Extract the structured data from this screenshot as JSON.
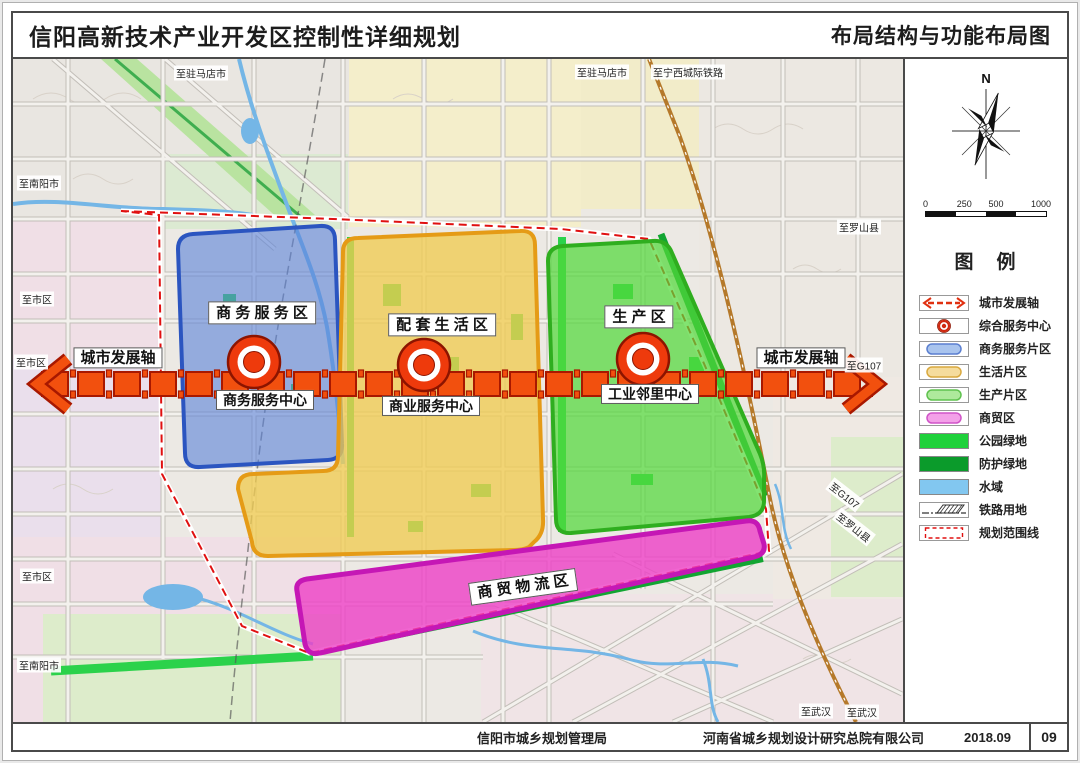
{
  "header": {
    "title_left": "信阳高新技术产业开发区控制性详细规划",
    "title_right": "布局结构与功能布局图"
  },
  "map": {
    "axis_label": "城市发展轴",
    "axis_color": "#f2500e",
    "axis_outline": "#a81800",
    "center_color": "#ee3a0c",
    "zones": [
      {
        "label": "商 务 服 务 区",
        "center_label": "商务服务中心",
        "fill": "#5a82d8",
        "stroke": "#2b55c0"
      },
      {
        "label": "配 套 生 活 区",
        "center_label": "商业服务中心",
        "fill": "#f0cc52",
        "stroke": "#e59b16"
      },
      {
        "label": "生 产 区",
        "center_label": "工业邻里中心",
        "fill": "#52d83a",
        "stroke": "#2fae1f"
      },
      {
        "label": "商 贸 物 流 区",
        "fill": "#ee3fc6",
        "stroke": "#c517b5"
      }
    ],
    "edge_labels": [
      {
        "text": "至驻马店市"
      },
      {
        "text": "至驻马店市"
      },
      {
        "text": "至宁西城际铁路"
      },
      {
        "text": "至南阳市"
      },
      {
        "text": "至市区"
      },
      {
        "text": "至市区"
      },
      {
        "text": "至市区"
      },
      {
        "text": "至南阳市"
      },
      {
        "text": "至罗山县"
      },
      {
        "text": "至G107"
      },
      {
        "text": "至G107"
      },
      {
        "text": "至罗山县"
      },
      {
        "text": "至武汉"
      },
      {
        "text": "至武汉"
      }
    ]
  },
  "panel": {
    "north_label": "N",
    "scale_labels": [
      "0",
      "250",
      "500",
      "1000"
    ],
    "legend_title": "图　例",
    "legend_items": [
      {
        "label": "城市发展轴",
        "color": "#e03010"
      },
      {
        "label": "综合服务中心",
        "color": "#d02810"
      },
      {
        "label": "商务服务片区",
        "color": "#a9c4ee",
        "stroke": "#5b7fd0"
      },
      {
        "label": "生活片区",
        "color": "#f5dc9d",
        "stroke": "#d9a93f"
      },
      {
        "label": "生产片区",
        "color": "#aee99c",
        "stroke": "#5fc24e"
      },
      {
        "label": "商贸区",
        "color": "#f3a0e8",
        "stroke": "#d054c8"
      },
      {
        "label": "公园绿地",
        "color": "#1fd13b"
      },
      {
        "label": "防护绿地",
        "color": "#0b9b2b"
      },
      {
        "label": "水域",
        "color": "#82c7f0"
      },
      {
        "label": "铁路用地",
        "color": "#333333"
      },
      {
        "label": "规划范围线",
        "color": "#e01010"
      }
    ]
  },
  "footer": {
    "agency": "信阳市城乡规划管理局",
    "designer": "河南省城乡规划设计研究总院有限公司",
    "date": "2018.09",
    "page": "09"
  }
}
